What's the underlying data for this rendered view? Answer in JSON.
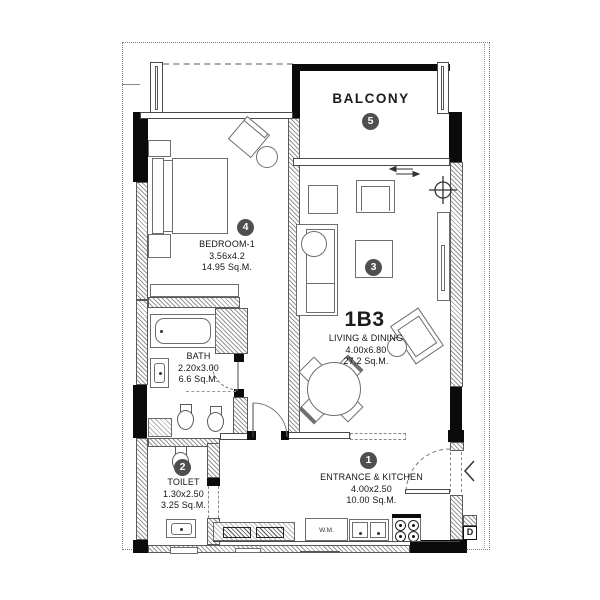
{
  "unit": {
    "code": "1B3"
  },
  "rooms": {
    "balcony": {
      "name": "BALCONY",
      "number": "5"
    },
    "bedroom": {
      "name": "BEDROOM-1",
      "dims": "3.56x4.2",
      "area": "14.95 Sq.M.",
      "number": "4"
    },
    "bath": {
      "name": "BATH",
      "dims": "2.20x3.00",
      "area": "6.6 Sq.M."
    },
    "toilet": {
      "name": "TOILET",
      "dims": "1.30x2.50",
      "area": "3.25 Sq.M.",
      "number": "2"
    },
    "living": {
      "name": "LIVING & DINING",
      "dims": "4.00x6.80",
      "area": "27.2 Sq.M.",
      "number": "3"
    },
    "entrance": {
      "name": "ENTRANCE & KITCHEN",
      "dims": "4.00x2.50",
      "area": "10.00 Sq.M.",
      "number": "1"
    }
  },
  "labels": {
    "washer": "W.M.",
    "door_tag": "D"
  },
  "colors": {
    "line": "#4a4a4a",
    "wall_fill": "#0b0b0b",
    "badge": "#4f4f4f",
    "hatch": "#979797",
    "background": "#ffffff"
  }
}
